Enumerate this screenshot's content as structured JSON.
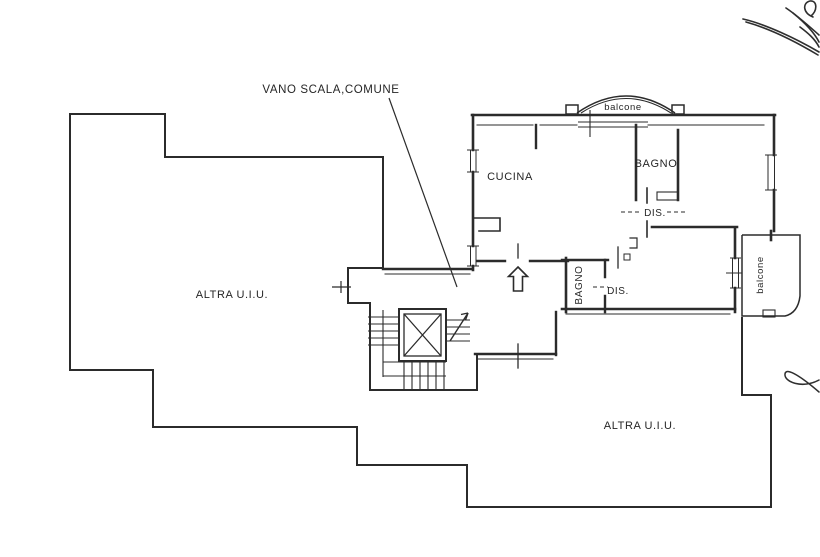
{
  "page": {
    "background": "#ffffff",
    "ink_color": "#262626"
  },
  "plan": {
    "callout": {
      "stairwell": "VANO SCALA,COMUNE"
    },
    "rooms": {
      "kitchen": "CUCINA",
      "bathroom_upper": "BAGNO",
      "hallway_upper": "DIS.",
      "bathroom_lower": "BAGNO",
      "hallway_lower": "DIS."
    },
    "balconies": {
      "top": "balcone",
      "right": "balcone"
    },
    "other_units": {
      "left": "ALTRA U.I.U.",
      "bottom_right": "ALTRA U.I.U."
    },
    "symbols": {
      "entrance_arrow": "up-arrow",
      "stair_direction_arrow": "diagonal-arrow",
      "elevator": "crossed-box"
    }
  }
}
